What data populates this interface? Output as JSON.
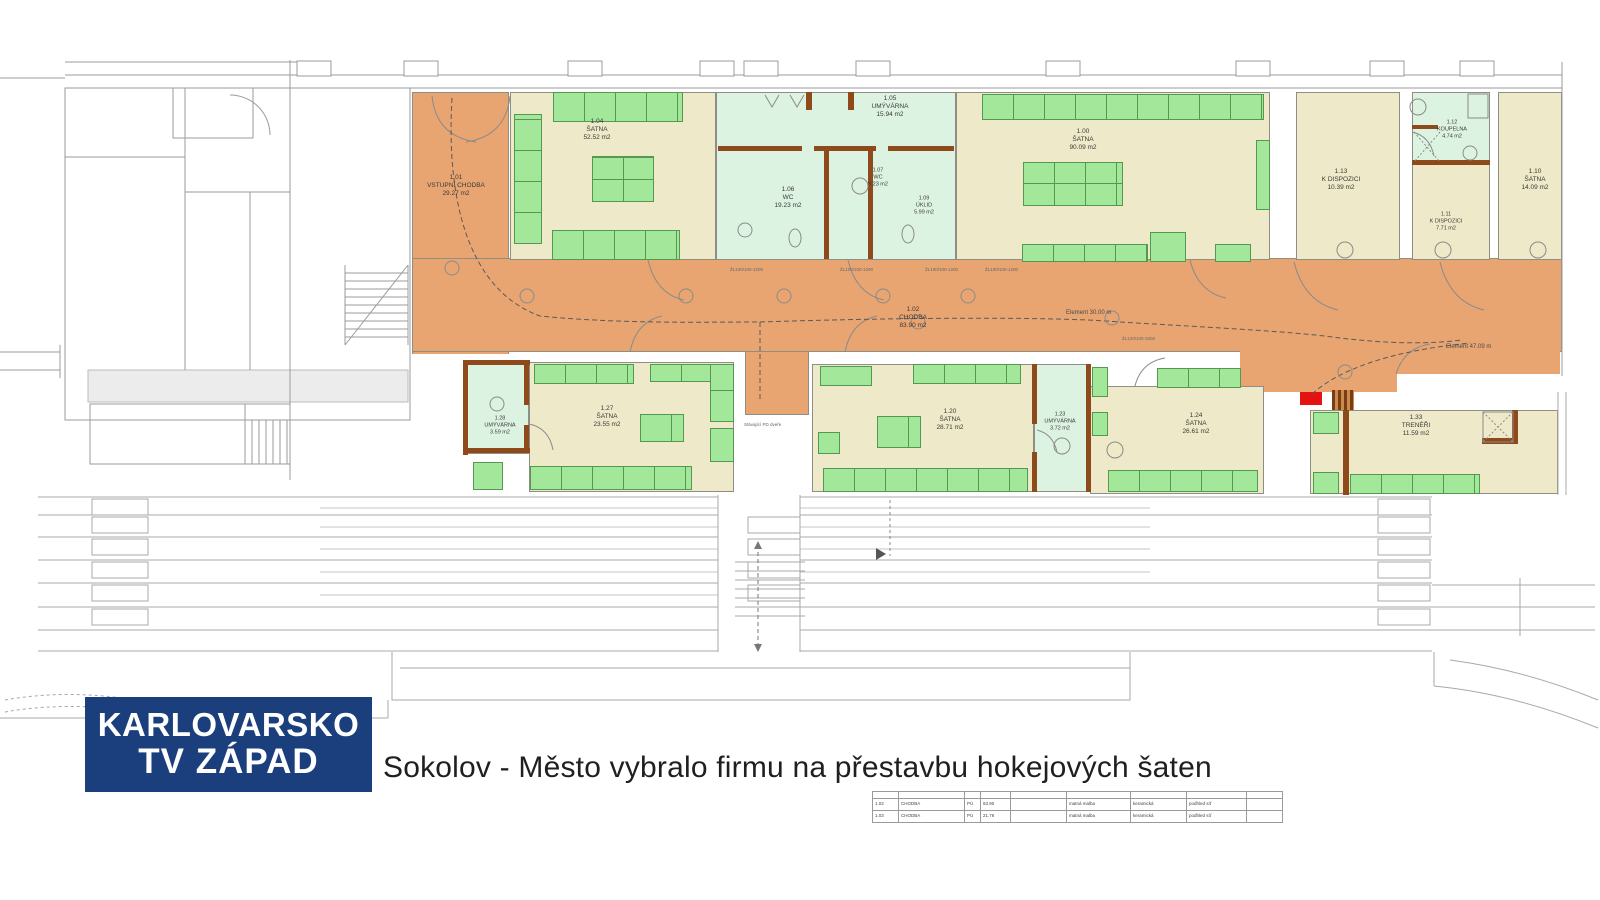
{
  "broadcaster": {
    "line1": "KARLOVARSKO",
    "line2": "TV ZÁPAD",
    "bg_color": "#1b3e7c"
  },
  "caption": {
    "text": "Sokolov - Město vybralo firmu na přestavbu hokejových šaten"
  },
  "plan": {
    "colors": {
      "corridor": "#e8a571",
      "room_beige": "#eee9c8",
      "bench_green": "#a3e79b",
      "wet_green": "#ddf3e1",
      "wall_brown": "#8f4a1c",
      "highlight_red": "#e51212"
    },
    "rooms": [
      {
        "id": "1.01",
        "name": "VSTUPNÍ CHODBA",
        "area": "29.27 m2"
      },
      {
        "id": "1.04",
        "name": "ŠATNA",
        "area": "52.52 m2"
      },
      {
        "id": "1.05",
        "name": "UMÝVÁRNA",
        "area": "15.94 m2"
      },
      {
        "id": "1.06",
        "name": "WC",
        "area": "19.23 m2"
      },
      {
        "id": "1.07",
        "name": "WC",
        "area": "3.23 m2"
      },
      {
        "id": "1.09",
        "name": "ÚKLID",
        "area": "5.99 m2"
      },
      {
        "id": "1.00",
        "name": "ŠATNA",
        "area": "90.09 m2"
      },
      {
        "id": "1.13",
        "name": "K DISPOZICI",
        "area": "10.39 m2"
      },
      {
        "id": "1.12",
        "name": "KOUPELNA",
        "area": "4.74 m2"
      },
      {
        "id": "1.11",
        "name": "K DISPOZICI",
        "area": "7.71 m2"
      },
      {
        "id": "1.10",
        "name": "ŠATNA",
        "area": "14.09 m2"
      },
      {
        "id": "1.02",
        "name": "CHODBA",
        "area": "83.90 m2"
      },
      {
        "id": "1.28",
        "name": "UMÝVÁRNA",
        "area": "3.59 m2"
      },
      {
        "id": "1.27",
        "name": "ŠATNA",
        "area": "23.55 m2"
      },
      {
        "id": "1.20",
        "name": "ŠATNA",
        "area": "28.71 m2"
      },
      {
        "id": "1.23",
        "name": "UMÝVÁRNA",
        "area": "3.72 m2"
      },
      {
        "id": "1.24",
        "name": "ŠATNA",
        "area": "26.61 m2"
      },
      {
        "id": "1.33",
        "name": "TRENÉŘI",
        "area": "11.59 m2"
      }
    ],
    "annotations": {
      "element30": "Element 30.00 m",
      "element47": "Element 47.09 m",
      "existing_door": "Stávající PD dveře",
      "lintel": "ŽL100/100-1200",
      "lintel2": "ŽL120/100-1000"
    }
  },
  "legend_table": {
    "rows": [
      [
        "1.02",
        "CHODBA",
        "PÚ",
        "83.90",
        "",
        "matná malba",
        "keramická",
        "podhled síť"
      ],
      [
        "1.03",
        "CHODBA",
        "PÚ",
        "21.76",
        "",
        "matná malba",
        "keramická",
        "podhled síť"
      ]
    ]
  }
}
